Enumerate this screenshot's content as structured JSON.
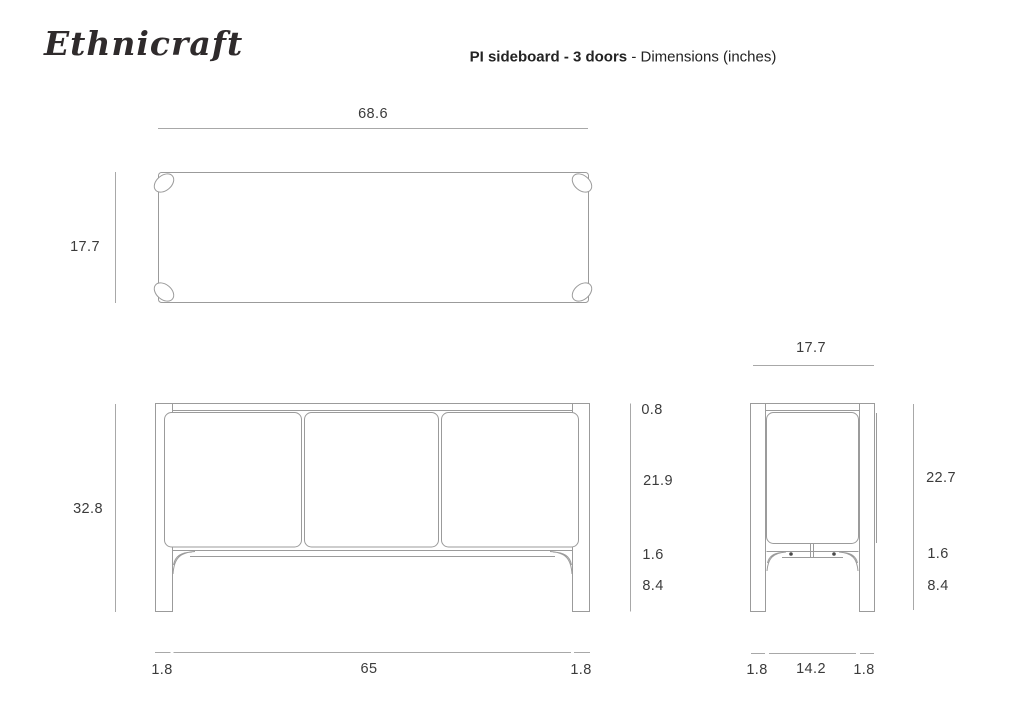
{
  "header": {
    "logo": "Ethnicraft",
    "title_bold": "PI sideboard - 3 doors",
    "title_regular": " - Dimensions (inches)"
  },
  "colors": {
    "background": "#ffffff",
    "drawing_line": "#9b9b9b",
    "dimension_line": "#a8a8a8",
    "text": "#3b3b3b"
  },
  "views": {
    "top": {
      "width": "68.6",
      "depth": "17.7"
    },
    "front": {
      "height": "32.8",
      "top_panel": "0.8",
      "door": "21.9",
      "rail": "1.6",
      "clearance": "8.4",
      "leg_left": "1.8",
      "inner_width": "65",
      "leg_right": "1.8"
    },
    "side": {
      "depth": "17.7",
      "door": "22.7",
      "rail": "1.6",
      "clearance": "8.4",
      "leg_front": "1.8",
      "inner_depth": "14.2",
      "leg_back": "1.8"
    }
  }
}
